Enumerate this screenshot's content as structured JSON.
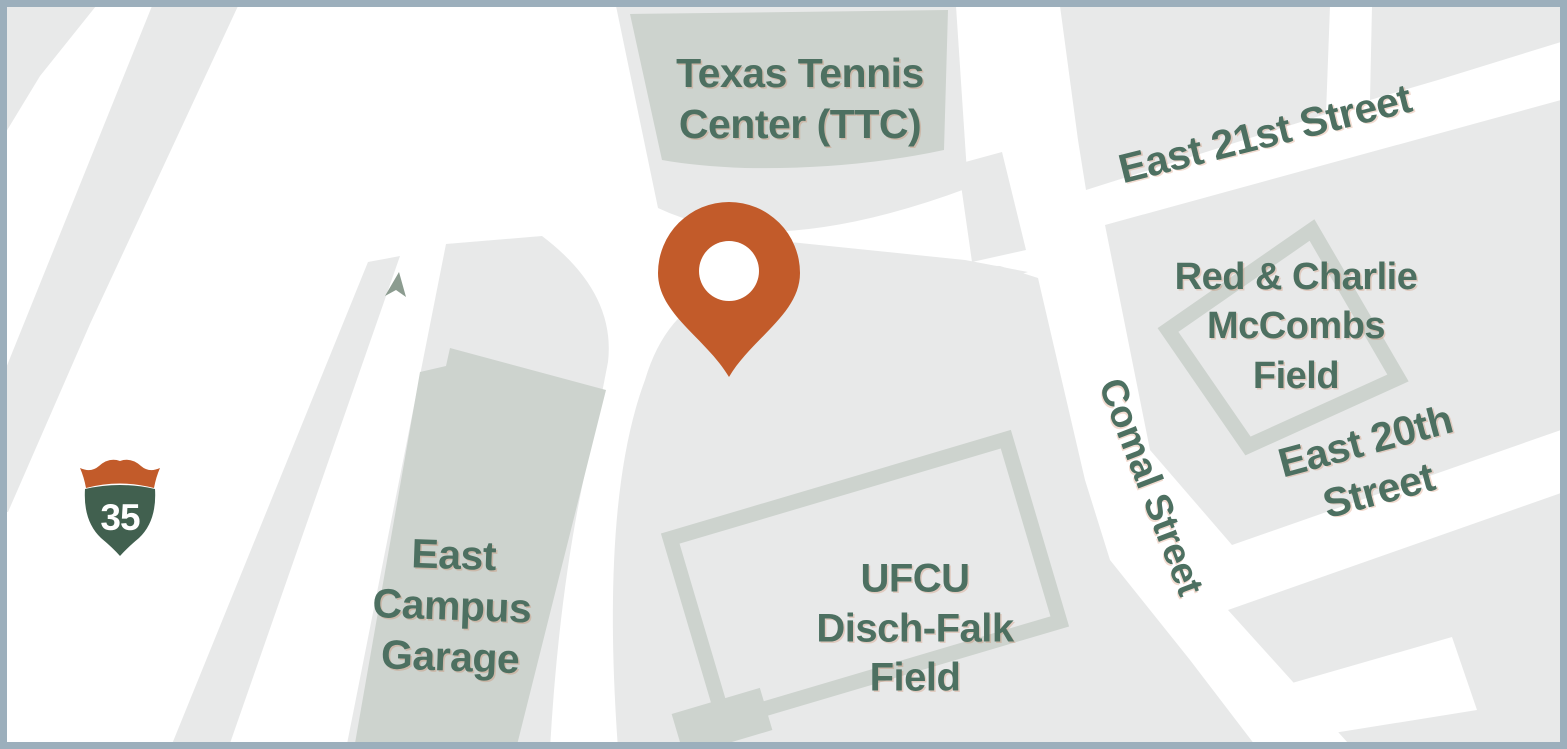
{
  "map": {
    "title": "Campus area map - Texas Tennis Center vicinity",
    "labels": {
      "tennis_center": "Texas Tennis\nCenter (TTC)",
      "east_21st": "East 21st Street",
      "mccombs_field": "Red & Charlie\nMcCombs\nField",
      "comal_street": "Comal Street",
      "east_20th": "East 20th Street",
      "campus_garage": "East\nCampus\nGarage",
      "disch_falk": "UFCU\nDisch-Falk\nField"
    },
    "shield": {
      "number": "35",
      "kind": "interstate-35-route-shield"
    },
    "marker": {
      "kind": "location-pin",
      "color": "#c25b2a"
    },
    "colors": {
      "border": "#9cafbc",
      "road": "#ffffff",
      "city_block": "#e8e9e9",
      "building": "#cdd3ce",
      "field_outline": "#cdd3ce",
      "label_text": "#4d7061",
      "shield_green": "#41604f",
      "accent_orange": "#c25b2a",
      "arrow_gray": "#8c9c90"
    }
  }
}
